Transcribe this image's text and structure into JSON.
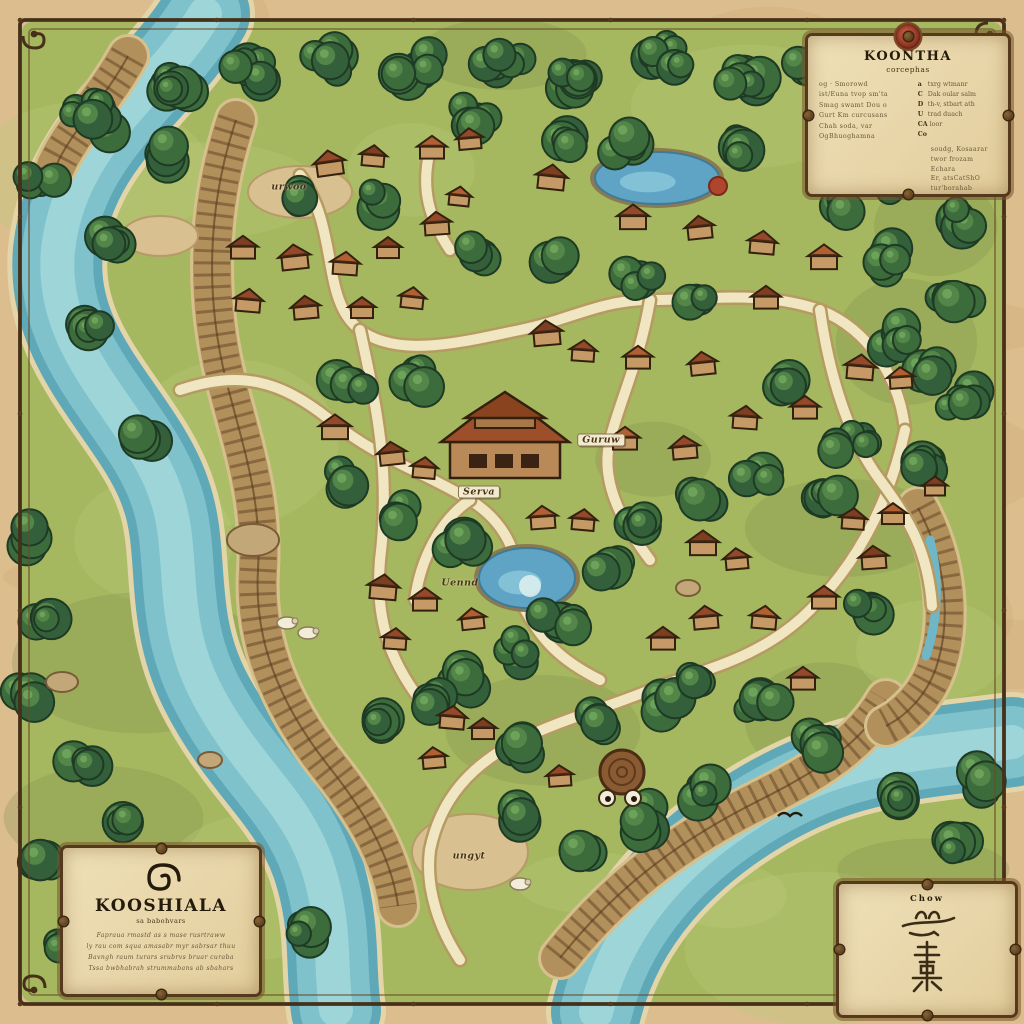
{
  "page_title": "Kooshiala village map",
  "legend_box": {
    "title": "KOONTHA",
    "subtitle": "corcephas",
    "left_items": [
      "og · Smorowd",
      "ist/Euna tvop sm'ta",
      "Smag swamt Dou o",
      "Gurt Km curcusans",
      "Chah soda, var",
      "OgBhuoghamna"
    ],
    "right_items": [
      {
        "glyph": "a",
        "label": "txrg wtmanr"
      },
      {
        "glyph": "C",
        "label": "Dak oular salm"
      },
      {
        "glyph": "D",
        "label": "th-v, stbart ath"
      },
      {
        "glyph": "U",
        "label": "trad duach"
      },
      {
        "glyph": "CA",
        "label": "loor"
      },
      {
        "glyph": "Co",
        "label": ""
      }
    ],
    "note_lines": [
      "soudg, Kosaarar",
      "twor frozam",
      "Echara",
      "Er, atsCatShO",
      "tur'borahab"
    ]
  },
  "title_box": {
    "title": "KOOSHIALA",
    "subtitle": "sa babohvars",
    "body_lines": [
      "Fapraua rmastd as s mase rusrtraww",
      "ly rau com squa amasabr myr sabrsar thuu",
      "Bavngh raum turars srubrvs bruar curaba",
      "Tssa bwbhabrah strummabans ab sbahars"
    ],
    "emblem": "spiral-icon"
  },
  "seal_box": {
    "title": "Chow",
    "emblem": "calligraphy-glyph"
  },
  "map": {
    "labels": [
      {
        "text": "urwoo",
        "x": 289,
        "y": 187,
        "banner": false
      },
      {
        "text": "Guruw",
        "x": 601,
        "y": 440,
        "banner": true
      },
      {
        "text": "Serva",
        "x": 479,
        "y": 492,
        "banner": true
      },
      {
        "text": "Uennd",
        "x": 460,
        "y": 583,
        "banner": false
      },
      {
        "text": "ungyt",
        "x": 469,
        "y": 856,
        "banner": false
      }
    ]
  },
  "colors": {
    "parchment": "#dcbd8e",
    "ink": "#2c2212",
    "grass": "#a5b75f",
    "forest": "#3c6b3c",
    "water": "#77bcc6",
    "path": "#f1e6c2",
    "roof": "#94492a",
    "seal_red": "#a8432e"
  }
}
